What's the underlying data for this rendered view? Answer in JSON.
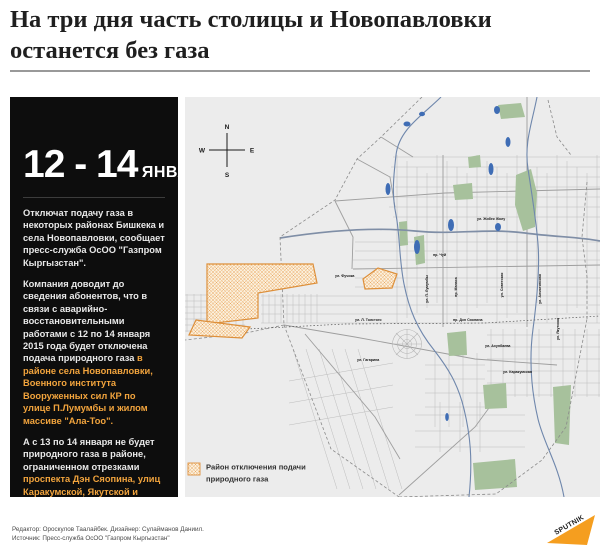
{
  "title": {
    "line1": "На три дня часть столицы и Новопавловки",
    "line2": "останется без газа"
  },
  "sidebar": {
    "date_range": "12 - 14",
    "date_unit": "ЯНВАРЯ",
    "p1": "Отключат подачу газа в некоторых районах Бишкека и села Новопавловки, сообщает пресс-служба ОсОО \"Газпром Кыргызстан\".",
    "p2_plain": "Компания доводит до сведения абонентов, что в связи с аварийно-восстановительными работами с 12 по 14 января 2015 года будет отключена подача природного газа",
    "p2_highlight": "в районе села Новопавловки, Военного института Вооруженных сил КР по улице П.Лумумбы и жилом массиве \"Ала-Тоо\".",
    "p3_plain": "А с 13 по 14 января не будет природного газа в районе, ограниченном отрезками",
    "p3_highlight": "проспекта Дэн Сяопина, улиц Каракумской, Якутской и Фучика."
  },
  "map": {
    "compass": {
      "n": "N",
      "s": "S",
      "w": "W",
      "e": "E"
    },
    "legend": {
      "line1": "Район отключения подачи",
      "line2": "природного газа"
    },
    "street_labels": [
      "пр. Чуй",
      "ул. Жибек Жолу",
      "ул. Л. Толстого",
      "пр. Дэн Сяопина",
      "ул. Гагарина",
      "ул. Ахунбаева",
      "ул. Фучика",
      "ул. Каракумская",
      "ул. Якутская",
      "ул. П. Лумумбы",
      "пр. Манаса",
      "ул. Советская",
      "ул. Алматинская"
    ]
  },
  "footer": {
    "credits_line1": "Редактор: Ороскулов Таалайбек. Дизайнер: Сулайманов Даниил.",
    "credits_line2": "Источник: Пресс-служба ОсОО \"Газпром Кыргызстан\"",
    "logo": "SPUTNIK"
  },
  "colors": {
    "highlight_text": "#F2A43D",
    "panel_bg": "#0D0D0D",
    "map_bg": "#ECECEC",
    "outage_fill_bg": "#FBF0DD",
    "outage_hatch": "#E8A254",
    "outage_border": "#DD8F3A",
    "park_green": "#A7C19C",
    "water_blue": "#6F87AC",
    "sputnik_orange": "#F59E1F"
  }
}
